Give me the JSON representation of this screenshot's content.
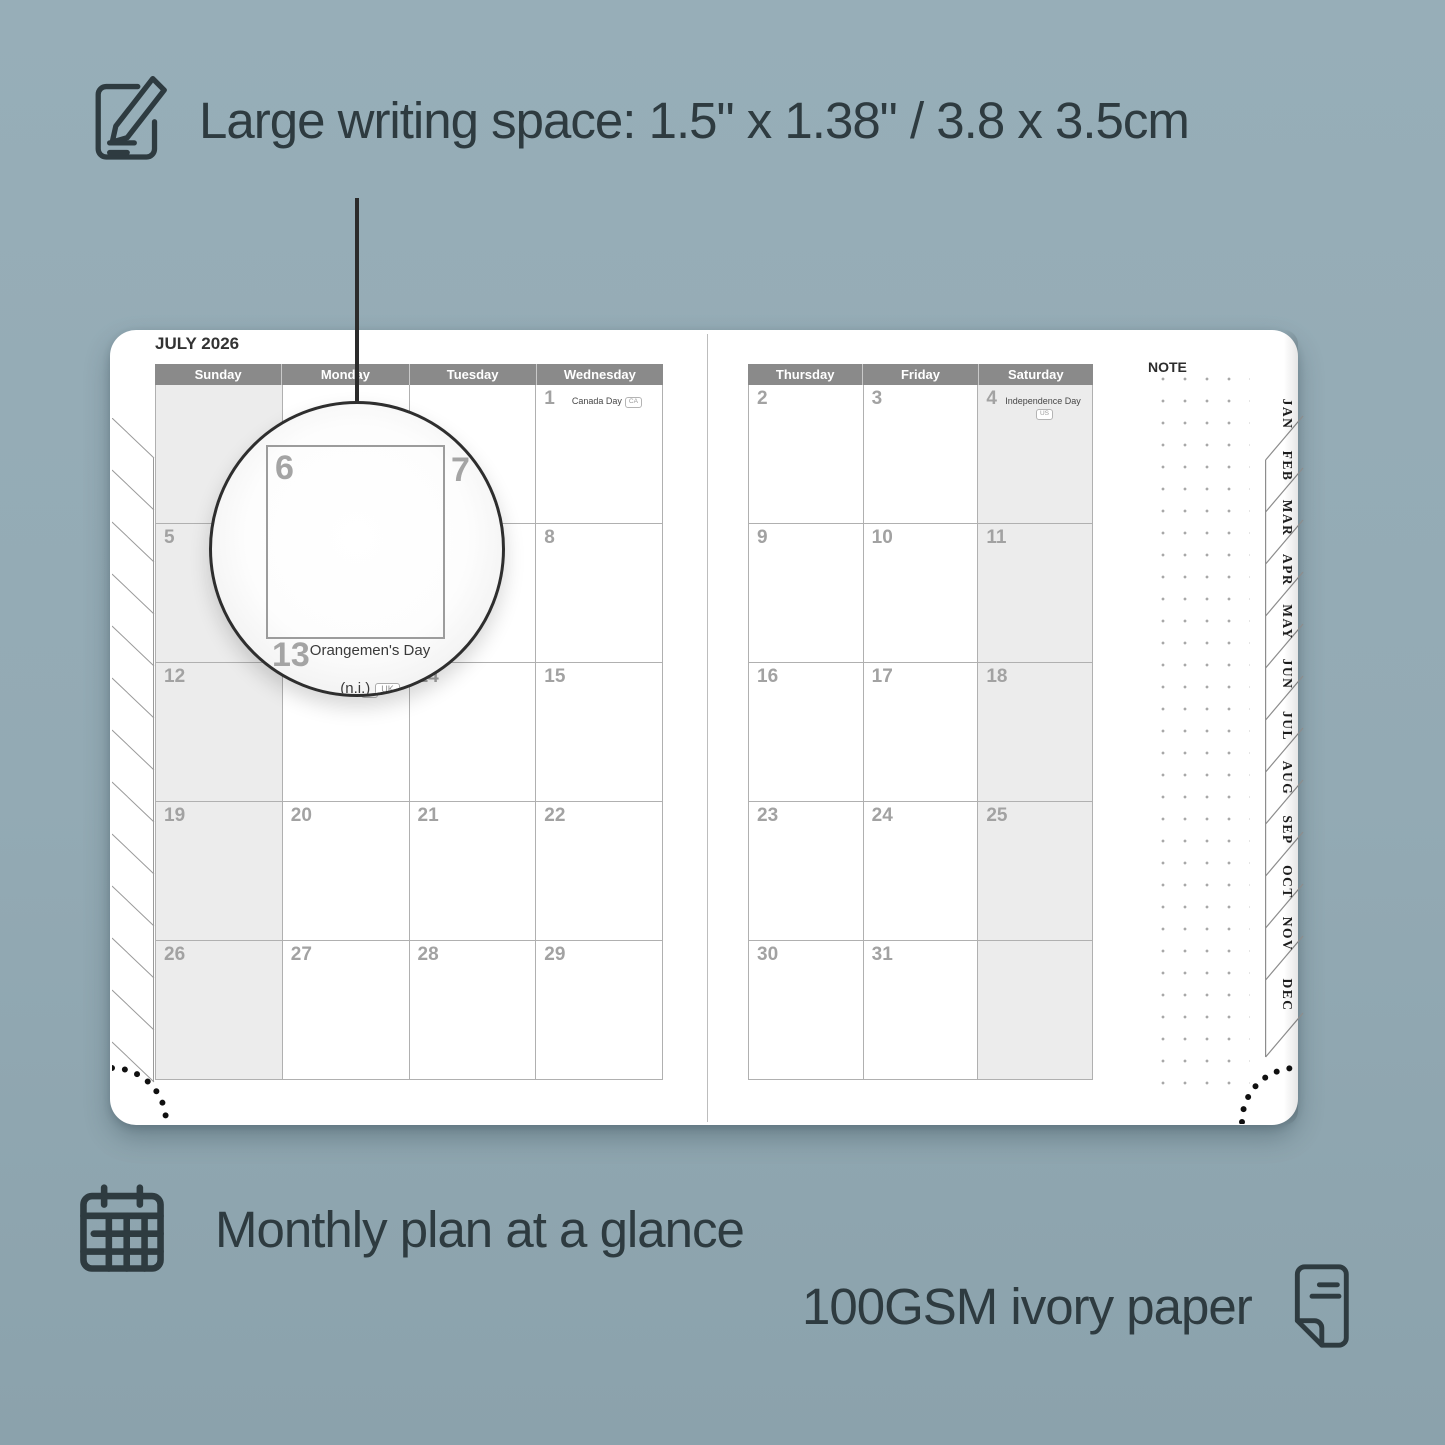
{
  "colors": {
    "background": "#93aab4",
    "ink": "#2e3b40",
    "page": "#ffffff",
    "header_bar": "#8a8a8a",
    "shaded_cell": "#ececec",
    "grid_line": "#b0b0b0",
    "day_number": "#a2a2a2",
    "holiday_text": "#474747",
    "stitch_dot": "#101010"
  },
  "features": {
    "top": {
      "icon": "pencil-note-icon",
      "text": "Large writing space: 1.5\" x 1.38\" / 3.8 x 3.5cm"
    },
    "bottom_left": {
      "icon": "calendar-grid-icon",
      "text": "Monthly plan at a glance"
    },
    "bottom_right": {
      "icon": "paper-sheet-icon",
      "text": "100GSM ivory paper"
    }
  },
  "planner": {
    "month_title": "JULY 2026",
    "note_label": "NOTE",
    "month_tabs": [
      "JAN",
      "FEB",
      "MAR",
      "APR",
      "MAY",
      "JUN",
      "JUL",
      "AUG",
      "SEP",
      "OCT",
      "NOV",
      "DEC"
    ],
    "left_grid": {
      "headers": [
        "Sunday",
        "Monday",
        "Tuesday",
        "Wednesday"
      ],
      "shaded_column": 0,
      "rows": [
        [
          {
            "day": ""
          },
          {
            "day": ""
          },
          {
            "day": ""
          },
          {
            "day": "1",
            "holiday": [
              "Canada Day"
            ],
            "badge": "CA"
          }
        ],
        [
          {
            "day": "5"
          },
          {
            "day": "6"
          },
          {
            "day": "7"
          },
          {
            "day": "8"
          }
        ],
        [
          {
            "day": "12"
          },
          {
            "day": "13",
            "holiday": [
              "Orangemen's Day",
              "(n.i.)"
            ],
            "badge": "UK"
          },
          {
            "day": "14"
          },
          {
            "day": "15"
          }
        ],
        [
          {
            "day": "19"
          },
          {
            "day": "20"
          },
          {
            "day": "21"
          },
          {
            "day": "22"
          }
        ],
        [
          {
            "day": "26"
          },
          {
            "day": "27"
          },
          {
            "day": "28"
          },
          {
            "day": "29"
          }
        ]
      ]
    },
    "right_grid": {
      "headers": [
        "Thursday",
        "Friday",
        "Saturday"
      ],
      "shaded_column": 2,
      "rows": [
        [
          {
            "day": "2"
          },
          {
            "day": "3"
          },
          {
            "day": "4",
            "holiday": [
              "Independence Day"
            ],
            "badge": "US"
          }
        ],
        [
          {
            "day": "9"
          },
          {
            "day": "10"
          },
          {
            "day": "11"
          }
        ],
        [
          {
            "day": "16"
          },
          {
            "day": "17"
          },
          {
            "day": "18"
          }
        ],
        [
          {
            "day": "23"
          },
          {
            "day": "24"
          },
          {
            "day": "25"
          }
        ],
        [
          {
            "day": "30"
          },
          {
            "day": "31"
          },
          {
            "day": ""
          }
        ]
      ]
    },
    "magnifier": {
      "day_main": "6",
      "day_next": "7",
      "day_below": "13",
      "holiday_line1": "Orangemen's Day",
      "holiday_line2": "(n.i.)",
      "badge": "UK"
    }
  }
}
